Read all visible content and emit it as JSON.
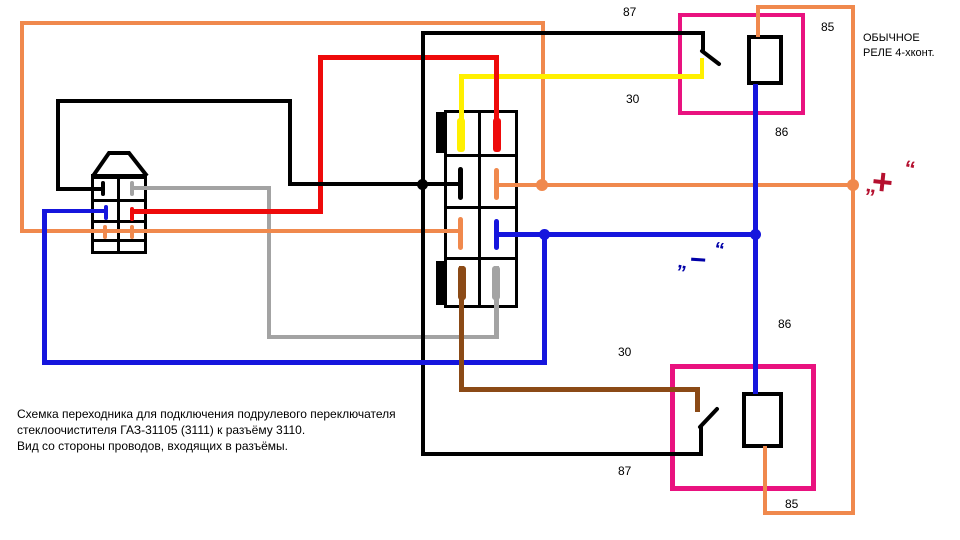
{
  "note": {
    "lines": [
      "Схемка переходника для подключения подрулевого переключателя",
      "стеклоочистителя ГАЗ-31105 (3111) к разъёму 3110.",
      "Вид со стороны проводов, входящих в разъёмы."
    ]
  },
  "relay_caption": {
    "line1": "ОБЫЧНОЕ",
    "line2": "РЕЛЕ 4-хконт."
  },
  "top_relay": {
    "pin_87": "87",
    "pin_30": "30",
    "pin_85": "85",
    "pin_86": "86"
  },
  "bottom_relay": {
    "pin_30": "30",
    "pin_87": "87",
    "pin_86": "86",
    "pin_85": "85"
  },
  "symbols": {
    "plus": {
      "quote_open": "„",
      "sign": "+",
      "quote_close": "“"
    },
    "minus": {
      "quote_open": "„",
      "sign": "−",
      "quote_close": "“"
    }
  },
  "colors": {
    "wire_orange": "#F0894D",
    "wire_red": "#EE0A0A",
    "wire_yellow": "#FFF000",
    "wire_black": "#000000",
    "wire_blue": "#1515DD",
    "wire_gray": "#A3A3A3",
    "wire_brown": "#8B4A16",
    "relay_border": "#E9127F",
    "plus_symbol": "#B5102F",
    "minus_symbol": "#0000A8"
  }
}
